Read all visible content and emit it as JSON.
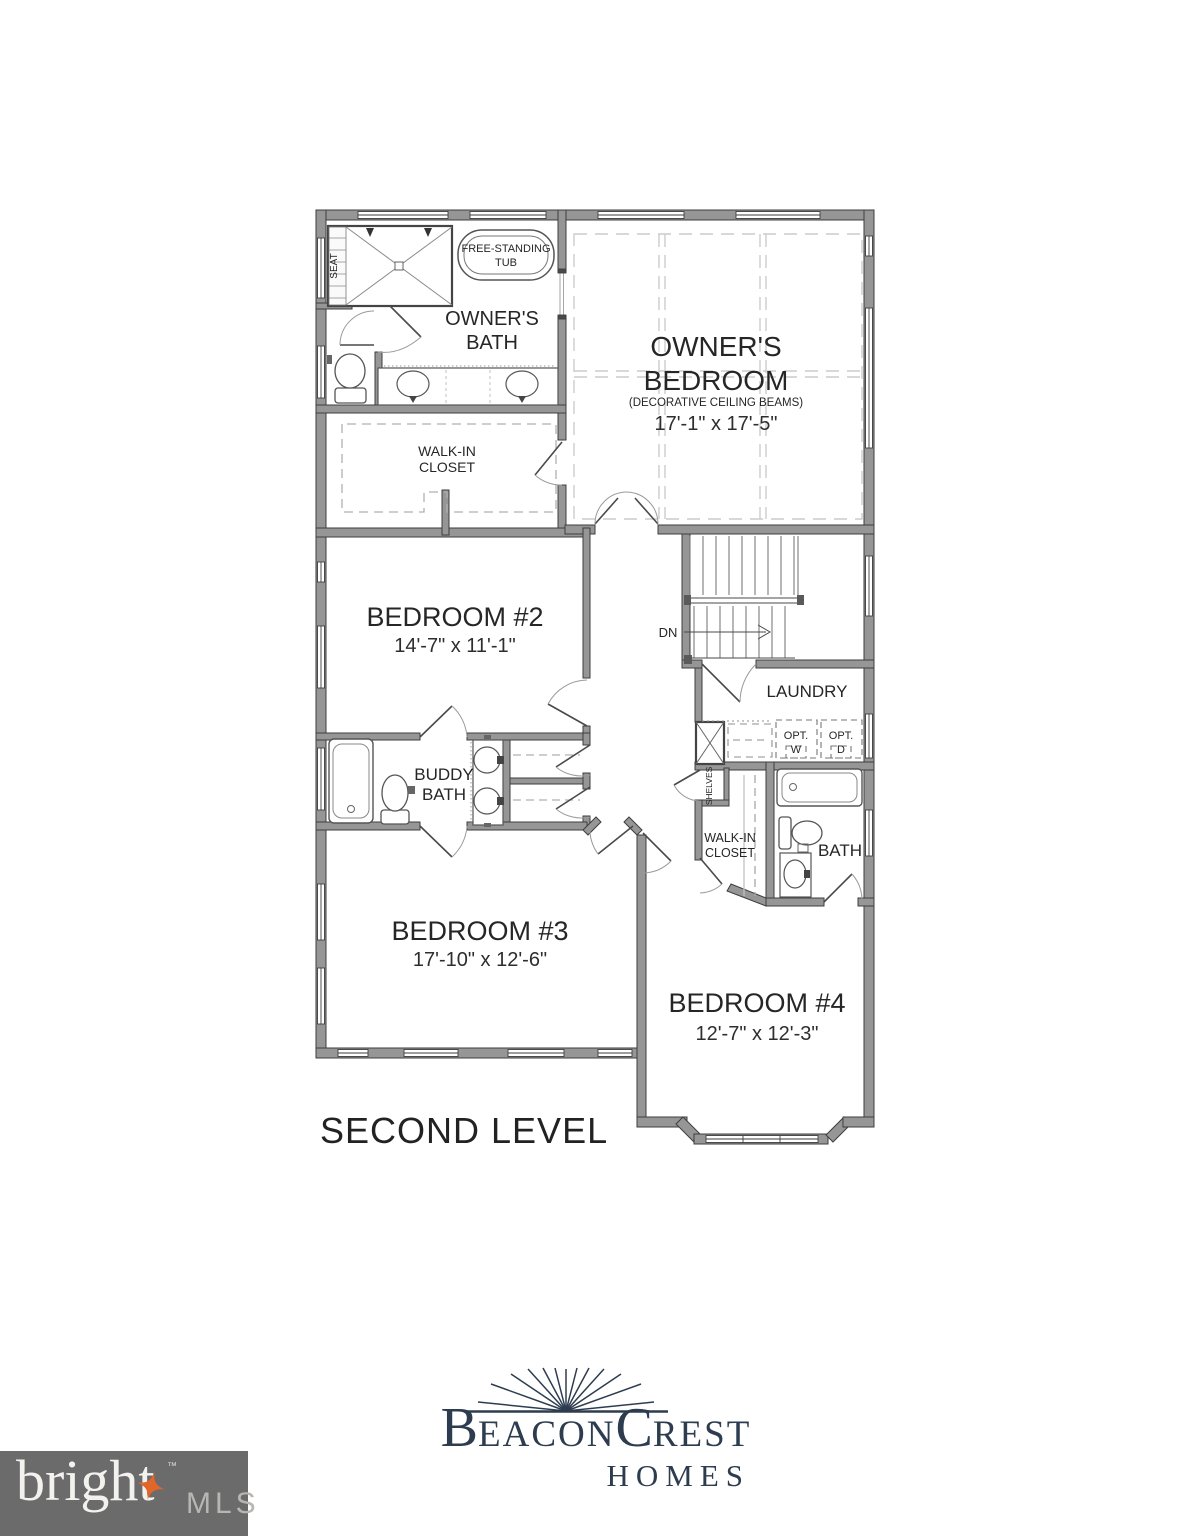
{
  "floorplan": {
    "level_title": "SECOND LEVEL",
    "rooms": {
      "owners_bedroom": {
        "l1": "OWNER'S",
        "l2": "BEDROOM",
        "note": "(DECORATIVE CEILING BEAMS)",
        "dims": "17'-1\" x 17'-5\""
      },
      "owners_bath": {
        "l1": "OWNER'S",
        "l2": "BATH"
      },
      "wic_owner": {
        "l1": "WALK-IN",
        "l2": "CLOSET"
      },
      "bedroom2": {
        "name": "BEDROOM #2",
        "dims": "14'-7\" x 11'-1\""
      },
      "bedroom3": {
        "name": "BEDROOM #3",
        "dims": "17'-10\" x 12'-6\""
      },
      "bedroom4": {
        "name": "BEDROOM #4",
        "dims": "12'-7\" x 12'-3\""
      },
      "buddy_bath": {
        "l1": "BUDDY",
        "l2": "BATH"
      },
      "laundry": {
        "name": "LAUNDRY",
        "optw1": "OPT.",
        "optw2": "W",
        "optd1": "OPT.",
        "optd2": "D"
      },
      "bath4": {
        "name": "BATH"
      },
      "wic_b4": {
        "l1": "WALK-IN",
        "l2": "CLOSET"
      },
      "shelves": {
        "name": "SHELVES"
      }
    },
    "fixtures": {
      "tub1": "FREE-STANDING",
      "tub2": "TUB",
      "seat": "SEAT",
      "stairs_dn": "DN"
    }
  },
  "builder_logo": {
    "part_b": "B",
    "part_eacon": "EACON",
    "part_c": "C",
    "part_rest": "REST",
    "homes": "HOMES",
    "color": "#2d3d4f"
  },
  "watermark": {
    "brand": "bright",
    "tm": "™",
    "mls": "MLS",
    "bg": "#6b6b6b",
    "star_color": "#e0662a",
    "text_color": "#f3f2ef",
    "mls_color": "#b8b6b3"
  },
  "colors": {
    "wall_fill": "#969696",
    "wall_edge": "#3e3e3e",
    "beam_dash": "#cccccc",
    "closet_dash": "#b0b0b0",
    "text": "#262626"
  }
}
